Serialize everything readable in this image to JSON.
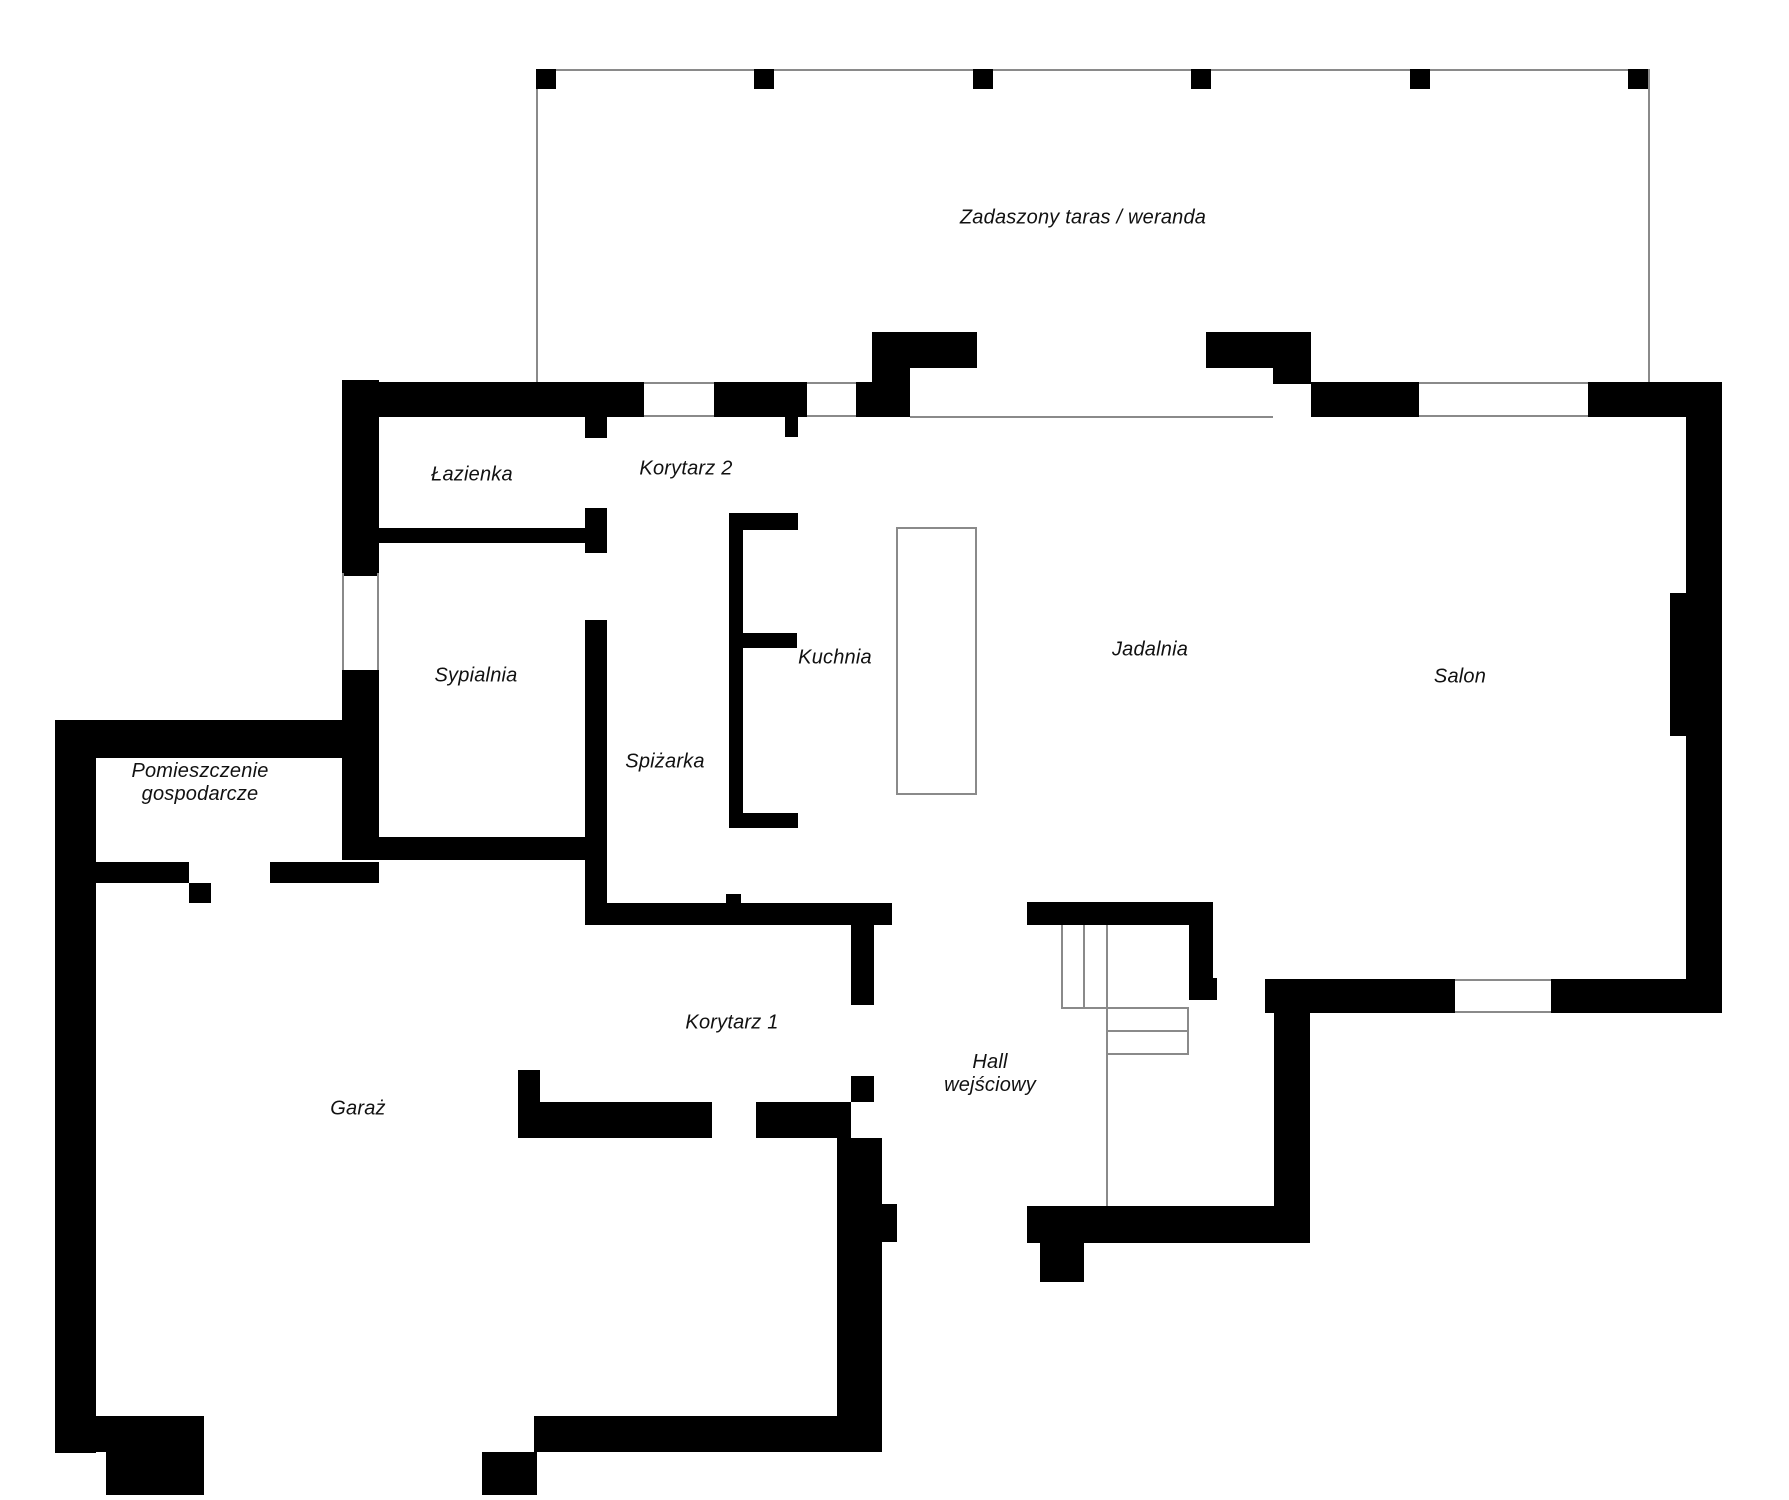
{
  "plan_title": "Rzut parteru — plan domu",
  "colors": {
    "wall": "#000000",
    "thin_line": "#8a8a8a",
    "label_text": "#111111",
    "background": "#ffffff"
  },
  "rooms": {
    "terrace": {
      "label": "Zadaszony taras / weranda"
    },
    "bathroom": {
      "label": "Łazienka"
    },
    "corridor2": {
      "label": "Korytarz 2"
    },
    "bedroom": {
      "label": "Sypialnia"
    },
    "kitchen": {
      "label": "Kuchnia"
    },
    "pantry": {
      "label": "Spiżarka"
    },
    "dining": {
      "label": "Jadalnia"
    },
    "living": {
      "label": "Salon"
    },
    "utility": {
      "label": "Pomieszczenie gospodarcze",
      "lines": [
        "Pomieszczenie",
        "gospodarcze"
      ]
    },
    "garage": {
      "label": "Garaż"
    },
    "corridor1": {
      "label": "Korytarz 1"
    },
    "hall": {
      "label": "Hall wejściowy",
      "lines": [
        "Hall",
        "wejściowy"
      ]
    }
  }
}
